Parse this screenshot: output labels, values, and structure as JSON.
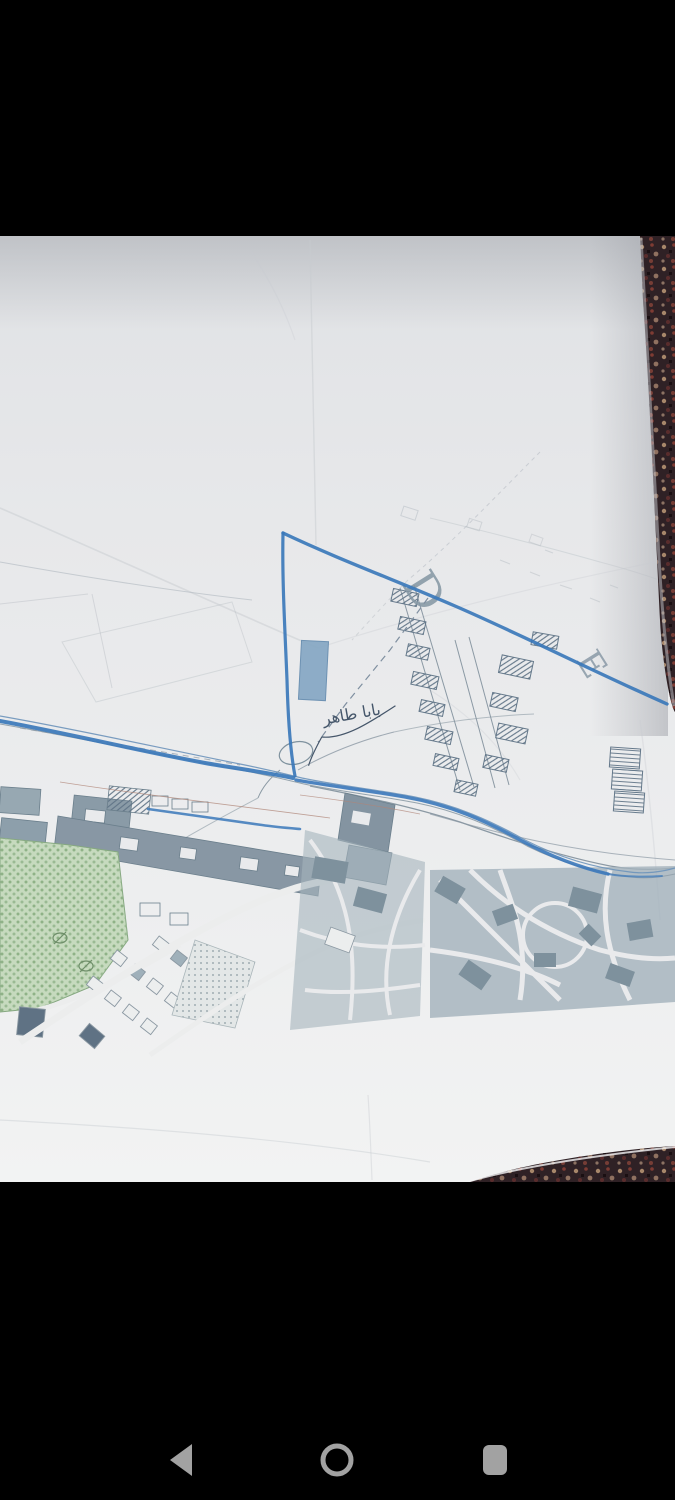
{
  "device": {
    "letterbox_color": "#000000",
    "nav_bar": {
      "icon_color": "#a2a2a2",
      "back_icon": "back-triangle",
      "home_icon": "home-circle",
      "recents_icon": "recents-square"
    }
  },
  "photo": {
    "subject": "paper town plan map lying on a patterned carpet",
    "paper_color": "#e9eaec",
    "carpet_color": "#2f2125"
  },
  "map": {
    "grid_letters": [
      {
        "text": "D"
      },
      {
        "text": "E"
      }
    ],
    "handwritten_label": {
      "text": "بابا طاهر",
      "color": "#45566a"
    },
    "features": {
      "highlight_color": "#3b78ba",
      "river_color": "#6d93ba",
      "park_color": "#c6dabe",
      "building_color": "#9fb0ba"
    }
  }
}
